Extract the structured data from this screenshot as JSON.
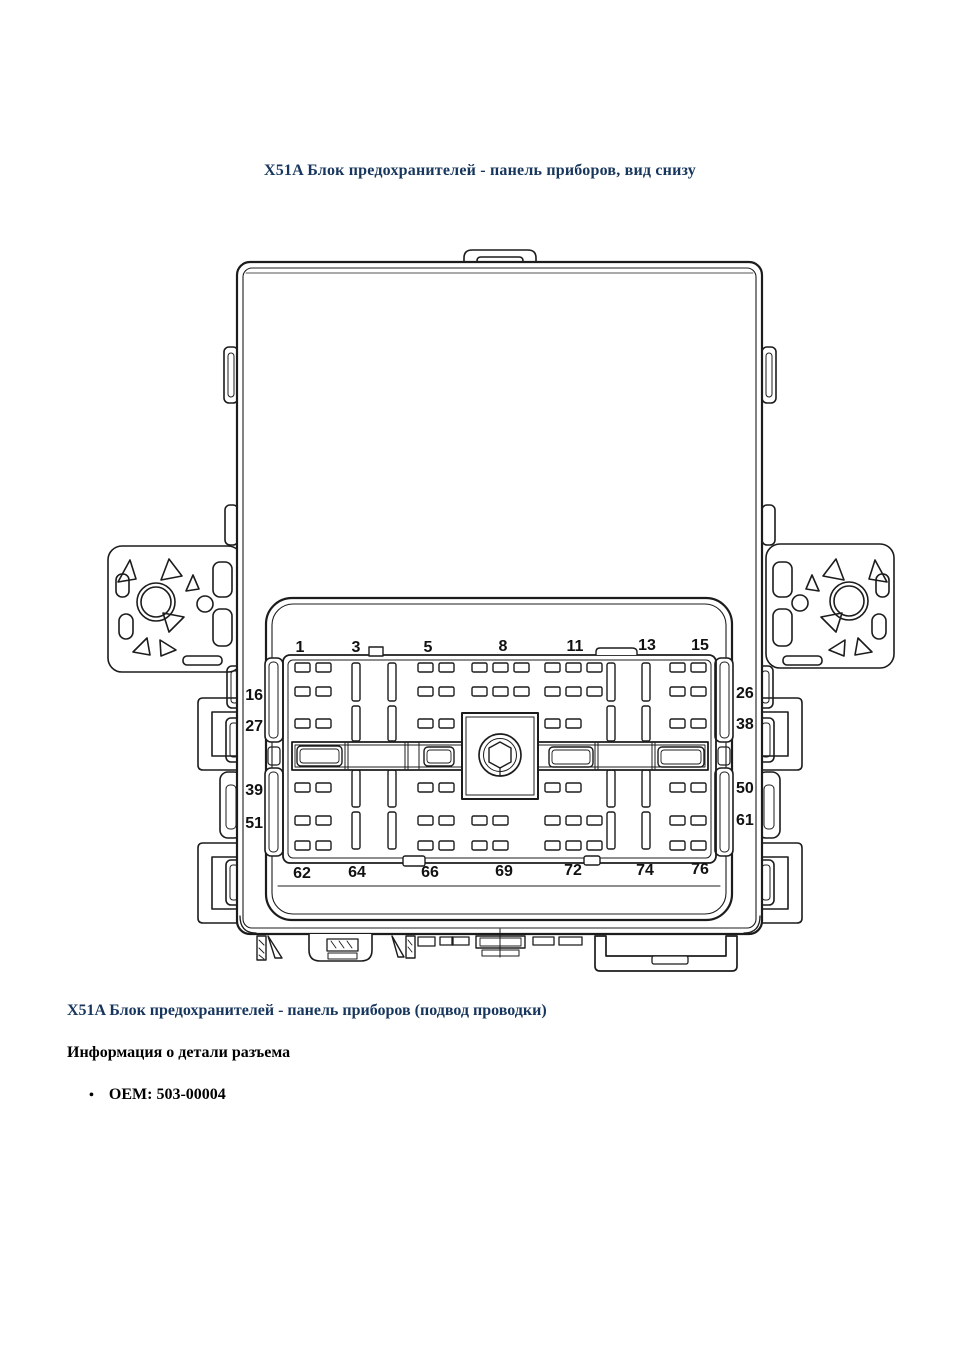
{
  "document": {
    "title": "X51A Блок предохранителей - панель приборов, вид снизу",
    "section_heading": "X51A Блок предохранителей - панель приборов (подвод проводки)",
    "subsection_heading": "Информация о детали разъема",
    "bullet_glyph": "•",
    "bullet_item": "OEM: 503-00004"
  },
  "diagram": {
    "pin_labels": {
      "top": [
        "1",
        "3",
        "5",
        "8",
        "11",
        "13",
        "15"
      ],
      "bottom": [
        "62",
        "64",
        "66",
        "69",
        "72",
        "74",
        "76"
      ],
      "left": [
        "16",
        "27",
        "39",
        "51"
      ],
      "right": [
        "26",
        "38",
        "50",
        "61"
      ]
    }
  },
  "colors": {
    "heading_blue": "#17365d",
    "body_text": "#000000",
    "line_art": "#1c1c1c",
    "background": "#ffffff"
  }
}
